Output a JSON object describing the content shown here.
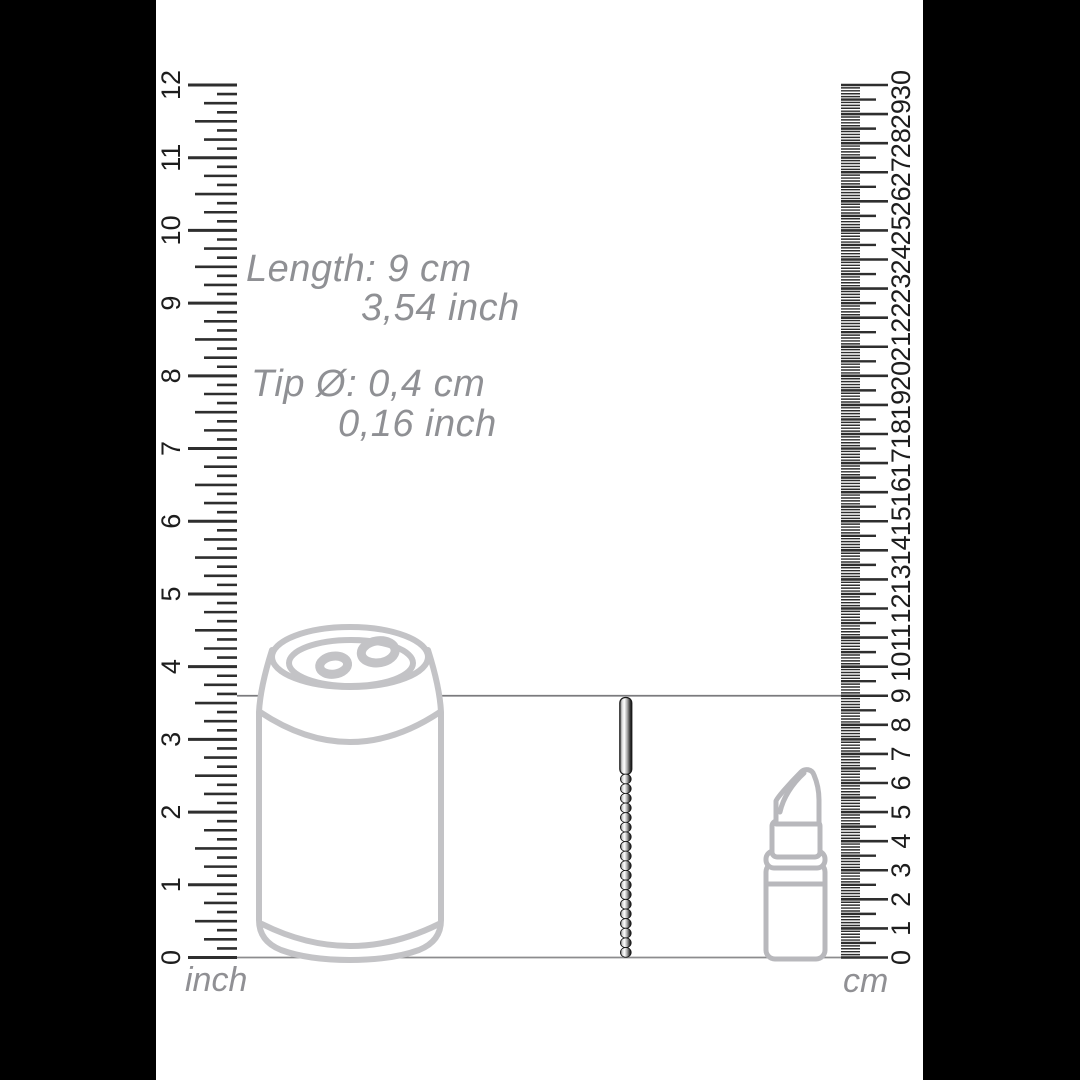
{
  "page": {
    "background_color": "#ffffff",
    "side_bar_color": "#000000",
    "description": "product dimension diagram"
  },
  "annotations": {
    "length_cm": "Length: 9 cm",
    "length_inch": "3,54 inch",
    "tip_cm": "Tip Ø: 0,4 cm",
    "tip_inch": "0,16 inch",
    "text_color": "#8f9094"
  },
  "rulers": {
    "tick_color": "#2e2e2e",
    "number_color": "#1d1d1d",
    "inch": {
      "unit_label": "inch",
      "min": 0,
      "max": 12,
      "subdivisions_per_unit": 8,
      "labels": [
        0,
        1,
        2,
        3,
        4,
        5,
        6,
        7,
        8,
        9,
        10,
        11,
        12
      ]
    },
    "cm": {
      "unit_label": "cm",
      "min": 0,
      "max": 30,
      "subdivisions_per_unit": 10,
      "labels": [
        0,
        1,
        2,
        3,
        4,
        5,
        6,
        7,
        8,
        9,
        10,
        11,
        12,
        13,
        14,
        15,
        16,
        17,
        18,
        19,
        20,
        21,
        22,
        23,
        24,
        25,
        26,
        27,
        28,
        29,
        30
      ]
    }
  },
  "scene": {
    "outline_color": "#c3c3c6",
    "lipstick_outline_color": "#b8b8bc",
    "guide_line_color": "#7a7a7d",
    "baseline_color": "#8c8c8e",
    "product_length_cm": 9,
    "objects": [
      {
        "name": "soda-can",
        "role": "size reference outline"
      },
      {
        "name": "beaded-rod-product",
        "role": "product, 9 cm tall, 0.4 cm tip diameter"
      },
      {
        "name": "lipstick",
        "role": "size reference outline"
      }
    ]
  }
}
